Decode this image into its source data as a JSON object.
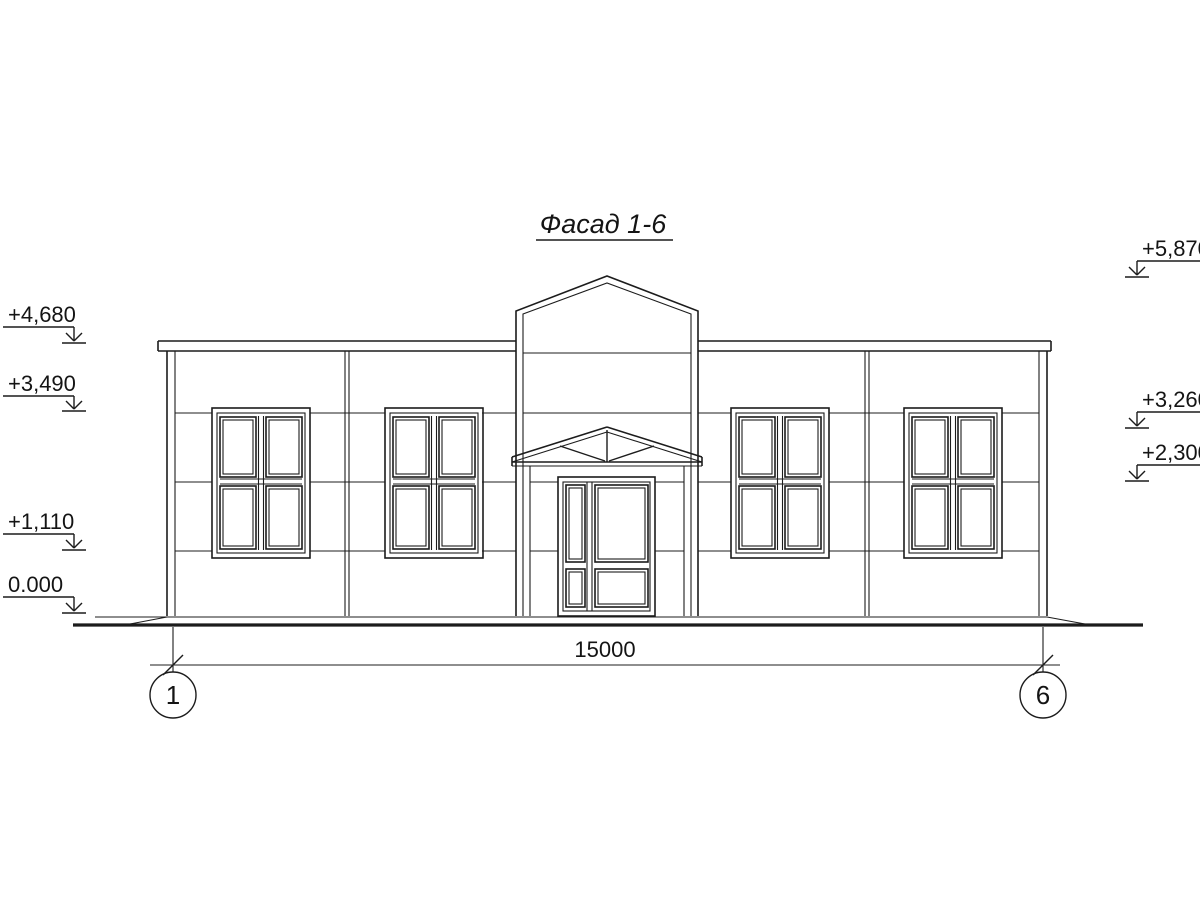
{
  "title": "Фасад 1-6",
  "colors": {
    "line": "#1c1c1c",
    "background": "#ffffff"
  },
  "elevation_marks_left": [
    {
      "label": "+4,680"
    },
    {
      "label": "+3,490"
    },
    {
      "label": "+1,110"
    },
    {
      "label": "0.000"
    }
  ],
  "elevation_marks_right": [
    {
      "label": "+5,870"
    },
    {
      "label": "+3,260"
    },
    {
      "label": "+2,300"
    }
  ],
  "dimension": {
    "length": "15000",
    "axis_left": "1",
    "axis_right": "6"
  }
}
